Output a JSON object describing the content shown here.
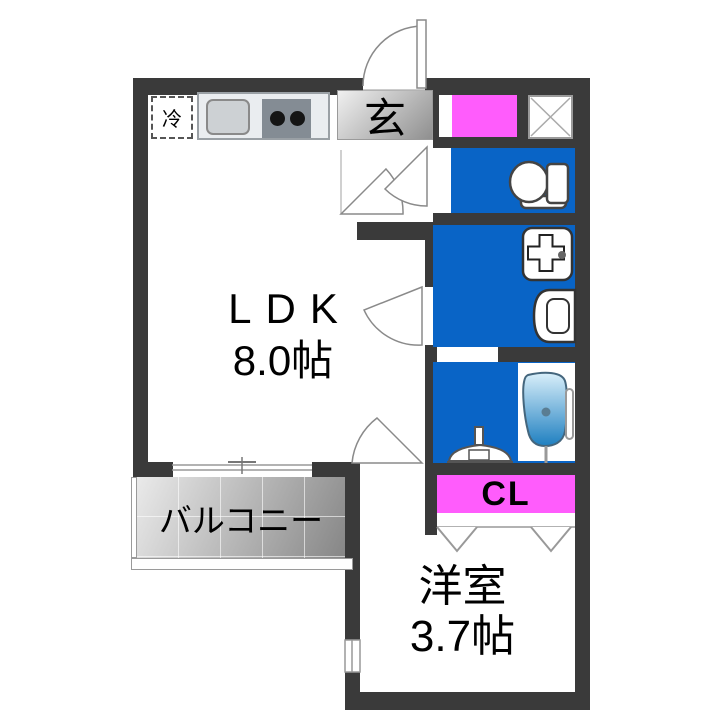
{
  "plan": {
    "type": "apartment-floorplan",
    "rooms": {
      "ldk": {
        "label": "LDK",
        "size": "8.0帖"
      },
      "western_room": {
        "label": "洋室",
        "size": "3.7帖"
      },
      "entrance": {
        "label": "玄"
      },
      "closet": {
        "label": "CL"
      },
      "balcony": {
        "label": "バルコニー"
      },
      "kitchen": {
        "refrigerator": "冷"
      }
    },
    "water_areas": [
      "toilet",
      "washroom-laundry",
      "bathroom"
    ],
    "fixtures": [
      "toilet",
      "washing-machine-pan",
      "washbasin",
      "bathtub",
      "shower-stand",
      "kitchen-sink",
      "gas-stove",
      "refrigerator-space",
      "shoe-cabinet",
      "pipe-space",
      "entry-door",
      "hinged-interior-doors",
      "sliding-window",
      "closet-folding-doors",
      "small-window"
    ],
    "colors": {
      "wall": "#3a3a3a",
      "water_room_fill": "#0964c6",
      "highlight_fill": "#ff5cfc",
      "genkan_fill_gradient": "#f0f0f0-#8f8f8f",
      "text": "#000000"
    }
  }
}
